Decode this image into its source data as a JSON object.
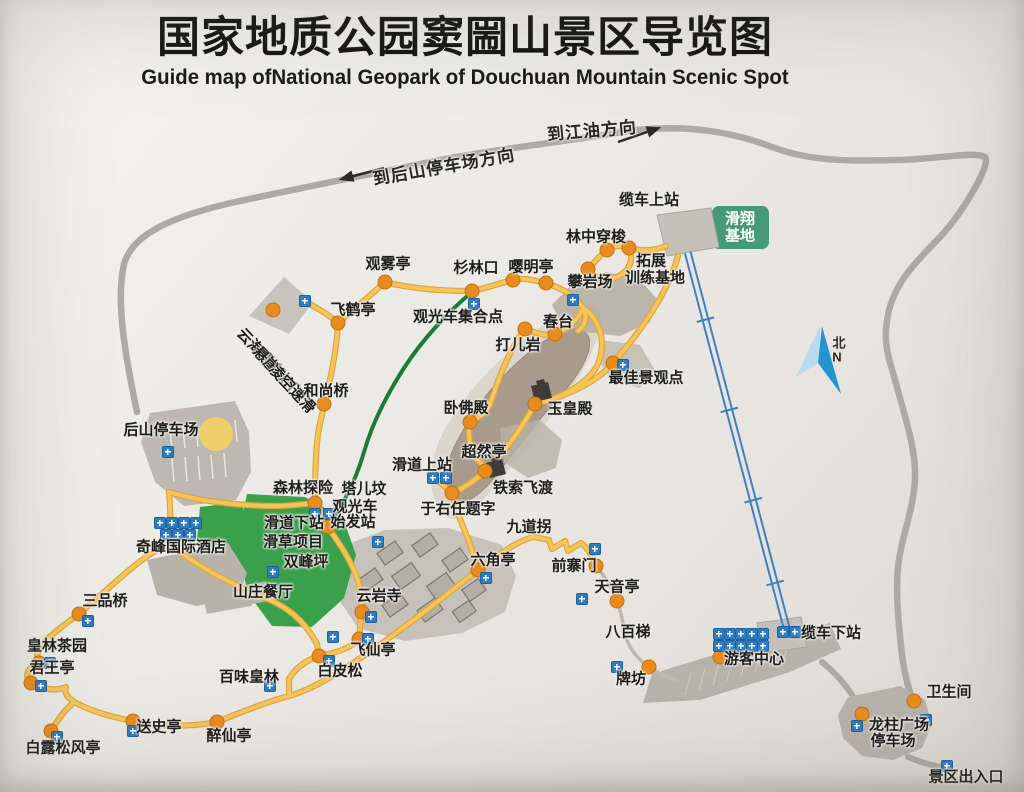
{
  "header": {
    "title": "国家地质公园窦圌山景区导览图",
    "subtitle": "Guide map ofNational Geopark of Douchuan Mountain Scenic Spot"
  },
  "colors": {
    "trail_yellow": "#f6c55a",
    "road_gray": "#aeaaa3",
    "tour_route_green": "#1d7a3d",
    "cableway_blue": "#4080c2",
    "green_area": "#3ba04b",
    "gliding_base_green": "#459a78",
    "poi_dot_orange": "#e98c1d",
    "facility_icon_blue": "#2e7cc2",
    "mountain_gray": "#a89b8c",
    "building_gray": "#b7b3ab"
  },
  "map": {
    "directions": [
      {
        "id": "direction-to-jiangyou",
        "text": "到江油方向",
        "x": 592,
        "y": 131,
        "rotate": -5,
        "cls": "lbl-dir"
      },
      {
        "id": "direction-to-rear-parking",
        "text": "到后山停车场方向",
        "x": 444,
        "y": 167,
        "rotate": -10,
        "cls": "lbl-dir"
      }
    ],
    "labels": [
      {
        "id": "cableway-upper-station",
        "text": "缆车上站",
        "x": 649,
        "y": 200
      },
      {
        "id": "gliding-base-line1",
        "text": "滑翔",
        "x": 740,
        "y": 219,
        "cls": "lbl-white"
      },
      {
        "id": "gliding-base-line2",
        "text": "基地",
        "x": 740,
        "y": 236,
        "cls": "lbl-white"
      },
      {
        "id": "forest-shuttle",
        "text": "林中穿梭",
        "x": 596,
        "y": 237
      },
      {
        "id": "training-base-line1",
        "text": "拓展",
        "x": 651,
        "y": 261
      },
      {
        "id": "training-base-line2",
        "text": "训练基地",
        "x": 655,
        "y": 278
      },
      {
        "id": "rock-climbing-field",
        "text": "攀岩场",
        "x": 590,
        "y": 282
      },
      {
        "id": "yingming-pavilion",
        "text": "嘤明亭",
        "x": 531,
        "y": 267
      },
      {
        "id": "shanlinkou",
        "text": "杉林口",
        "x": 476,
        "y": 268
      },
      {
        "id": "mist-viewing-pavilion",
        "text": "观雾亭",
        "x": 388,
        "y": 264
      },
      {
        "id": "flying-crane-pavilion",
        "text": "飞鹤亭",
        "x": 353,
        "y": 310
      },
      {
        "id": "sightseeing-bus-assembly-point",
        "text": "观光车集合点",
        "x": 458,
        "y": 317
      },
      {
        "id": "spring-terrace",
        "text": "春台",
        "x": 558,
        "y": 322
      },
      {
        "id": "daer-rock",
        "text": "打儿岩",
        "x": 518,
        "y": 345
      },
      {
        "id": "best-viewpoint",
        "text": "最佳景观点",
        "x": 646,
        "y": 378
      },
      {
        "id": "jade-emperor-hall",
        "text": "玉皇殿",
        "x": 570,
        "y": 409
      },
      {
        "id": "reclining-buddha-hall",
        "text": "卧佛殿",
        "x": 466,
        "y": 408
      },
      {
        "id": "chaoran-pavilion",
        "text": "超然亭",
        "x": 484,
        "y": 452
      },
      {
        "id": "slideway-upper-station",
        "text": "滑道上站",
        "x": 422,
        "y": 465
      },
      {
        "id": "iron-cable-crossing",
        "text": "铁索飞渡",
        "x": 523,
        "y": 488
      },
      {
        "id": "yu-youren-inscription",
        "text": "于右任题字",
        "x": 458,
        "y": 509
      },
      {
        "id": "nine-bends",
        "text": "九道拐",
        "x": 529,
        "y": 527
      },
      {
        "id": "cloud-sea-walk-line1",
        "text": "云海漫步",
        "x": 260,
        "y": 353,
        "rotate": 47
      },
      {
        "id": "cloud-sea-walk-line2",
        "text": "悬崖秋千",
        "x": 276,
        "y": 371,
        "rotate": 47
      },
      {
        "id": "cloud-sea-walk-line3",
        "text": "凌空速滑",
        "x": 292,
        "y": 389,
        "rotate": 47
      },
      {
        "id": "monk-bridge",
        "text": "和尚桥",
        "x": 326,
        "y": 391
      },
      {
        "id": "rear-mountain-parking",
        "text": "后山停车场",
        "x": 161,
        "y": 430
      },
      {
        "id": "forest-adventure",
        "text": "森林探险",
        "x": 303,
        "y": 488
      },
      {
        "id": "taerfen",
        "text": "塔儿坟",
        "x": 364,
        "y": 489
      },
      {
        "id": "bus-departure-line1",
        "text": "观光车",
        "x": 355,
        "y": 507
      },
      {
        "id": "bus-departure-line2",
        "text": "始发站",
        "x": 353,
        "y": 522
      },
      {
        "id": "slideway-lower-station",
        "text": "滑道下站",
        "x": 294,
        "y": 523
      },
      {
        "id": "grass-skiing-project",
        "text": "滑草项目",
        "x": 293,
        "y": 542
      },
      {
        "id": "twin-peaks-flat",
        "text": "双峰坪",
        "x": 306,
        "y": 562
      },
      {
        "id": "qifeng-international-hotel",
        "text": "奇峰国际酒店",
        "x": 181,
        "y": 547
      },
      {
        "id": "villa-restaurant",
        "text": "山庄餐厅",
        "x": 263,
        "y": 592
      },
      {
        "id": "yunyan-temple",
        "text": "云岩寺",
        "x": 379,
        "y": 596
      },
      {
        "id": "hexagonal-pavilion",
        "text": "六角亭",
        "x": 493,
        "y": 560
      },
      {
        "id": "front-stockade-gate",
        "text": "前寨门",
        "x": 574,
        "y": 566
      },
      {
        "id": "tianyin-pavilion",
        "text": "天音亭",
        "x": 617,
        "y": 587
      },
      {
        "id": "sanpin-bridge",
        "text": "三品桥",
        "x": 105,
        "y": 601
      },
      {
        "id": "huanglin-tea-garden",
        "text": "皇林茶园",
        "x": 57,
        "y": 646
      },
      {
        "id": "junwang-pavilion",
        "text": "君王亭",
        "x": 52,
        "y": 668
      },
      {
        "id": "baiwei-huanglin",
        "text": "百味皇林",
        "x": 249,
        "y": 677
      },
      {
        "id": "white-bark-pine",
        "text": "白皮松",
        "x": 340,
        "y": 671
      },
      {
        "id": "feixian-pavilion",
        "text": "飞仙亭",
        "x": 373,
        "y": 650
      },
      {
        "id": "eight-hundred-steps",
        "text": "八百梯",
        "x": 628,
        "y": 632
      },
      {
        "id": "cableway-lower-station",
        "text": "缆车下站",
        "x": 831,
        "y": 633
      },
      {
        "id": "visitor-center",
        "text": "游客中心",
        "x": 754,
        "y": 659
      },
      {
        "id": "memorial-archway",
        "text": "牌坊",
        "x": 631,
        "y": 679
      },
      {
        "id": "songshi-pavilion",
        "text": "送史亭",
        "x": 159,
        "y": 727
      },
      {
        "id": "zuixian-pavilion",
        "text": "醉仙亭",
        "x": 229,
        "y": 736
      },
      {
        "id": "bailu-songfeng-pavilion",
        "text": "白露松风亭",
        "x": 63,
        "y": 748
      },
      {
        "id": "restroom",
        "text": "卫生间",
        "x": 949,
        "y": 692
      },
      {
        "id": "dragon-pillar-plaza-line1",
        "text": "龙柱广场",
        "x": 899,
        "y": 725
      },
      {
        "id": "dragon-pillar-plaza-line2",
        "text": "停车场",
        "x": 893,
        "y": 741
      },
      {
        "id": "scenic-area-entrance",
        "text": "景区出入口",
        "x": 966,
        "y": 777
      },
      {
        "id": "compass-north-cn",
        "text": "北",
        "x": 839,
        "y": 343,
        "cls": "lbl-compass"
      },
      {
        "id": "compass-north-en",
        "text": "N",
        "x": 837,
        "y": 357,
        "cls": "lbl-compass"
      }
    ],
    "dots": [
      {
        "id": "forest-shuttle-a",
        "x": 607,
        "y": 250
      },
      {
        "id": "forest-shuttle-b",
        "x": 629,
        "y": 248
      },
      {
        "id": "rock-climbing",
        "x": 588,
        "y": 269
      },
      {
        "id": "yingming-pavilion",
        "x": 546,
        "y": 283
      },
      {
        "id": "trail-junction",
        "x": 513,
        "y": 280
      },
      {
        "id": "shanlinkou",
        "x": 472,
        "y": 291
      },
      {
        "id": "mist-viewing-pavilion",
        "x": 385,
        "y": 282
      },
      {
        "id": "flying-crane-pavilion",
        "x": 338,
        "y": 323
      },
      {
        "id": "cloud-sea-walk",
        "x": 273,
        "y": 310
      },
      {
        "id": "monk-bridge",
        "x": 324,
        "y": 404
      },
      {
        "id": "spring-terrace",
        "x": 555,
        "y": 334
      },
      {
        "id": "daer-rock",
        "x": 525,
        "y": 329
      },
      {
        "id": "best-viewpoint",
        "x": 613,
        "y": 363
      },
      {
        "id": "jade-emperor-hall",
        "x": 535,
        "y": 404
      },
      {
        "id": "reclining-buddha-hall",
        "x": 470,
        "y": 422
      },
      {
        "id": "chaoran-pavilion",
        "x": 485,
        "y": 471
      },
      {
        "id": "yu-youren-inscription",
        "x": 452,
        "y": 493
      },
      {
        "id": "hexagonal-pavilion",
        "x": 478,
        "y": 570
      },
      {
        "id": "front-stockade-gate",
        "x": 596,
        "y": 566
      },
      {
        "id": "tianyin-pavilion",
        "x": 617,
        "y": 601
      },
      {
        "id": "memorial-archway",
        "x": 649,
        "y": 667
      },
      {
        "id": "yunyan-temple",
        "x": 362,
        "y": 612
      },
      {
        "id": "feixian-pavilion",
        "x": 359,
        "y": 639
      },
      {
        "id": "white-bark-pine",
        "x": 319,
        "y": 656
      },
      {
        "id": "forest-adventure",
        "x": 315,
        "y": 503
      },
      {
        "id": "bus-departure-station",
        "x": 328,
        "y": 527
      },
      {
        "id": "sanpin-bridge",
        "x": 79,
        "y": 614
      },
      {
        "id": "huanglin-tea-garden",
        "x": 39,
        "y": 663
      },
      {
        "id": "junwang-pavilion",
        "x": 31,
        "y": 683
      },
      {
        "id": "songshi-pavilion",
        "x": 133,
        "y": 721
      },
      {
        "id": "zuixian-pavilion",
        "x": 217,
        "y": 722
      },
      {
        "id": "bailu-songfeng-pavilion",
        "x": 51,
        "y": 731
      },
      {
        "id": "restroom",
        "x": 914,
        "y": 701
      },
      {
        "id": "dragon-pillar-plaza",
        "x": 862,
        "y": 714
      },
      {
        "id": "visitor-center",
        "x": 720,
        "y": 657
      }
    ],
    "icons": [
      {
        "id": "cloud-sea-walk-icon",
        "x": 305,
        "y": 301
      },
      {
        "id": "bus-assembly-icon",
        "x": 474,
        "y": 304
      },
      {
        "id": "climbing-area-icon",
        "x": 573,
        "y": 300
      },
      {
        "id": "slideway-upper-icon-1",
        "x": 433,
        "y": 478
      },
      {
        "id": "slideway-upper-icon-2",
        "x": 446,
        "y": 478
      },
      {
        "id": "best-viewpoint-icon",
        "x": 623,
        "y": 365
      },
      {
        "id": "front-gate-icon",
        "x": 595,
        "y": 549
      },
      {
        "id": "tianyin-icon",
        "x": 582,
        "y": 599
      },
      {
        "id": "archway-icon",
        "x": 617,
        "y": 667
      },
      {
        "id": "baiwei-icon",
        "x": 270,
        "y": 686
      },
      {
        "id": "songshi-icon",
        "x": 133,
        "y": 731
      },
      {
        "id": "bailu-icon",
        "x": 57,
        "y": 737
      },
      {
        "id": "junwang-icon",
        "x": 41,
        "y": 686
      },
      {
        "id": "tea-garden-icon",
        "x": 50,
        "y": 663
      },
      {
        "id": "sanpin-icon",
        "x": 88,
        "y": 621
      },
      {
        "id": "rear-parking-icon",
        "x": 168,
        "y": 452
      },
      {
        "id": "restroom-icon",
        "x": 926,
        "y": 720
      },
      {
        "id": "dragon-plaza-icon",
        "x": 857,
        "y": 726
      },
      {
        "id": "entrance-icon",
        "x": 947,
        "y": 766
      },
      {
        "id": "forest-adventure-icon-1",
        "x": 315,
        "y": 514
      },
      {
        "id": "forest-adventure-icon-2",
        "x": 329,
        "y": 514
      },
      {
        "id": "yunyan-icon",
        "x": 371,
        "y": 617
      },
      {
        "id": "feixian-icon",
        "x": 368,
        "y": 639
      },
      {
        "id": "white-pine-icon",
        "x": 329,
        "y": 661
      },
      {
        "id": "trail-facility-icon",
        "x": 333,
        "y": 637
      },
      {
        "id": "hexagon-icon",
        "x": 486,
        "y": 578
      },
      {
        "id": "villa-restaurant-icon",
        "x": 273,
        "y": 572
      },
      {
        "id": "temple-facility-icon",
        "x": 378,
        "y": 542
      },
      {
        "id": "hotel-services-icon-1",
        "x": 160,
        "y": 523
      },
      {
        "id": "hotel-services-icon-2",
        "x": 172,
        "y": 523
      },
      {
        "id": "hotel-services-icon-3",
        "x": 184,
        "y": 523
      },
      {
        "id": "hotel-services-icon-4",
        "x": 196,
        "y": 523
      },
      {
        "id": "hotel-services-icon-5",
        "x": 166,
        "y": 535
      },
      {
        "id": "hotel-services-icon-6",
        "x": 178,
        "y": 535
      },
      {
        "id": "hotel-services-icon-7",
        "x": 190,
        "y": 535
      },
      {
        "id": "visitor-center-icon-1",
        "x": 719,
        "y": 634
      },
      {
        "id": "visitor-center-icon-2",
        "x": 730,
        "y": 634
      },
      {
        "id": "visitor-center-icon-3",
        "x": 741,
        "y": 634
      },
      {
        "id": "visitor-center-icon-4",
        "x": 752,
        "y": 634
      },
      {
        "id": "visitor-center-icon-5",
        "x": 763,
        "y": 634
      },
      {
        "id": "visitor-center-icon-6",
        "x": 719,
        "y": 646
      },
      {
        "id": "visitor-center-icon-7",
        "x": 730,
        "y": 646
      },
      {
        "id": "visitor-center-icon-8",
        "x": 741,
        "y": 646
      },
      {
        "id": "visitor-center-icon-9",
        "x": 752,
        "y": 646
      },
      {
        "id": "visitor-center-icon-10",
        "x": 763,
        "y": 646
      },
      {
        "id": "cableway-lower-icon-1",
        "x": 783,
        "y": 632
      },
      {
        "id": "cableway-lower-icon-2",
        "x": 795,
        "y": 632
      }
    ]
  }
}
